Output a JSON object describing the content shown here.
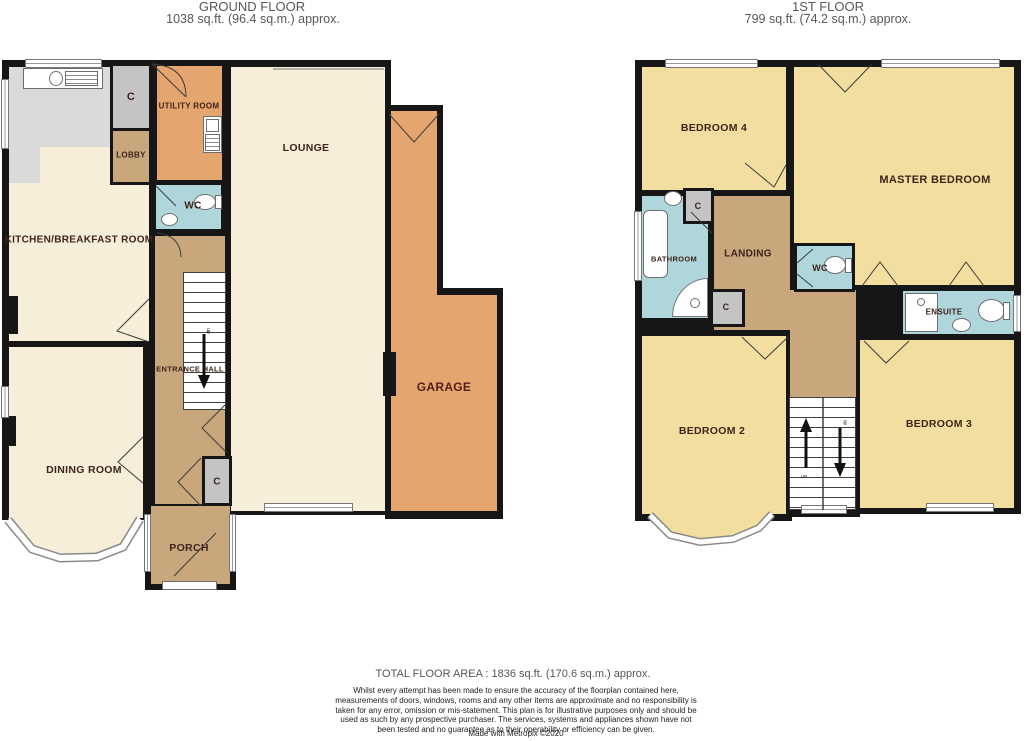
{
  "ground_floor": {
    "title": "GROUND FLOOR",
    "area": "1038 sq.ft. (96.4 sq.m.) approx.",
    "rooms": {
      "utility": "UTILITY ROOM",
      "cupboard": "C",
      "lobby": "LOBBY",
      "wc": "WC",
      "kitchen": "KITCHEN/BREAKFAST ROOM",
      "lounge": "LOUNGE",
      "entrance_hall": "ENTRANCE HALL",
      "dining": "DINING ROOM",
      "garage": "GARAGE",
      "hall_cupboard": "C",
      "porch": "PORCH"
    },
    "stairs_direction": "up"
  },
  "first_floor": {
    "title": "1ST FLOOR",
    "area": "799 sq.ft. (74.2 sq.m.) approx.",
    "rooms": {
      "bedroom4": "BEDROOM 4",
      "master_bedroom": "MASTER BEDROOM",
      "bathroom": "BATHROOM",
      "cupboard_top": "C",
      "landing": "LANDING",
      "wc": "WC",
      "cupboard_mid": "C",
      "ensuite": "ENSUITE",
      "bedroom2": "BEDROOM 2",
      "bedroom3": "BEDROOM 3"
    },
    "stairs_up": "UP",
    "stairs_down": "up"
  },
  "footer": {
    "total_area": "TOTAL FLOOR AREA : 1836 sq.ft. (170.6 sq.m.) approx.",
    "disclaimer": "Whilst every attempt has been made to ensure the accuracy of the floorplan contained here, measurements of doors, windows, rooms and any other items are approximate and no responsibility is taken for any error, omission or mis-statement. This plan is for illustrative purposes only and should be used as such by any prospective purchaser. The services, systems and appliances shown have not been tested and no guarantee as to their operability or efficiency can be given.",
    "credit": "Made with Metropix ©2020"
  },
  "colors": {
    "wall": "#161616",
    "room_cream": "#F6EED8",
    "room_yellow": "#F2DFA0",
    "room_orange": "#E4A56E",
    "room_tan": "#C8A77D",
    "room_blue": "#AFD6DB",
    "cupboard_gray": "#C4C4C4",
    "kitchen_floor": "#DADADA",
    "label_text": "#3E241B",
    "title_text": "#585858"
  }
}
